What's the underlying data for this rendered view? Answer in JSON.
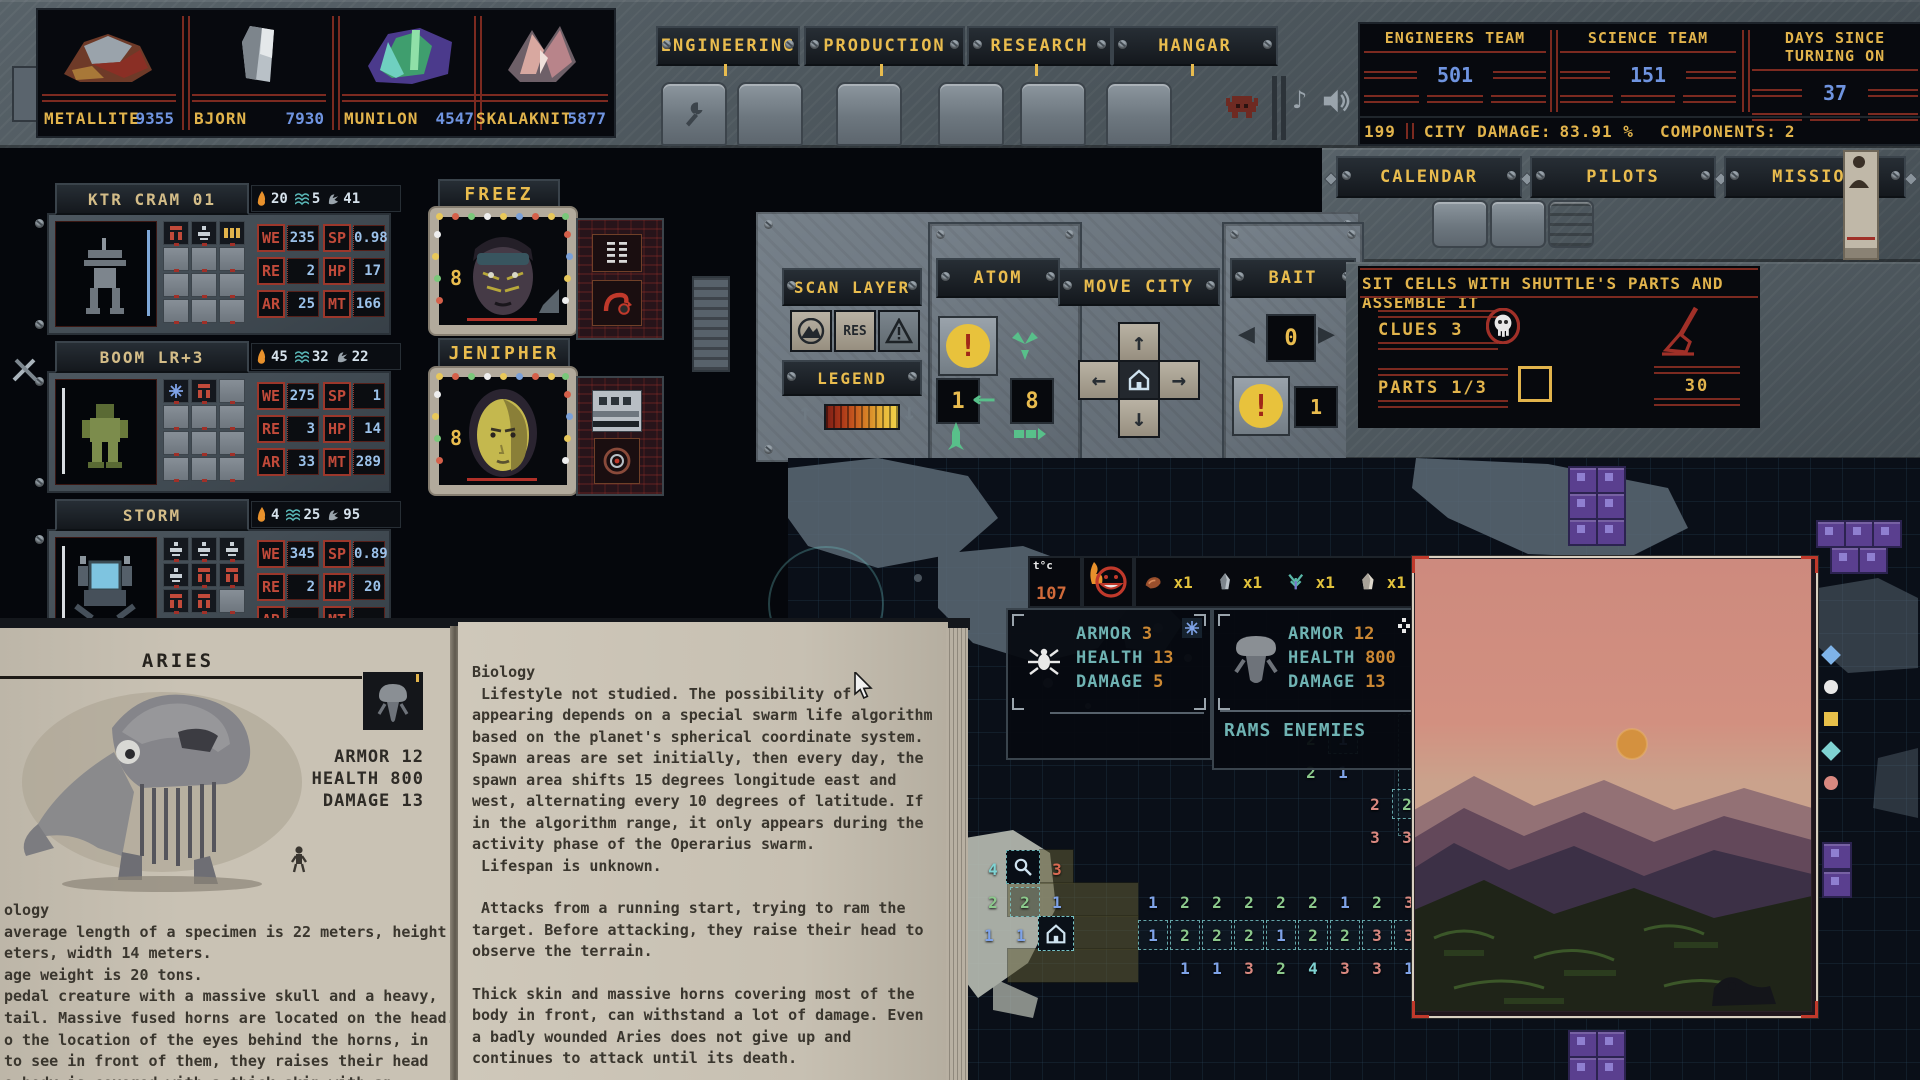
{
  "icons": {
    "music_note": "♪",
    "arrow_up": "↑",
    "arrow_down": "↓",
    "arrow_left": "←",
    "arrow_right": "→",
    "tri_left": "◀",
    "tri_right": "▶",
    "long_arrow_left": "←",
    "warning_mark": "!"
  },
  "resources": [
    {
      "name": "METALLITE",
      "value": "9355"
    },
    {
      "name": "BJORN",
      "value": "7930"
    },
    {
      "name": "MUNILON",
      "value": "4547"
    },
    {
      "name": "SKALAKNIT",
      "value": "5877"
    }
  ],
  "top_tabs": [
    {
      "label": "ENGINEERING"
    },
    {
      "label": "PRODUCTION"
    },
    {
      "label": "RESEARCH"
    },
    {
      "label": "HANGAR"
    }
  ],
  "teams": [
    {
      "label": "ENGINEERS TEAM",
      "value": "501"
    },
    {
      "label": "SCIENCE TEAM",
      "value": "151"
    },
    {
      "label": "DAYS SINCE TURNING ON",
      "value": "37"
    }
  ],
  "status": {
    "left_value": "199",
    "city_damage_label": "CITY DAMAGE:",
    "city_damage_value": "83.91 %",
    "components_label": "COMPONENTS:",
    "components_value": "2"
  },
  "nav_tabs": [
    {
      "label": "CALENDAR"
    },
    {
      "label": "PILOTS"
    },
    {
      "label": "MISSION"
    }
  ],
  "stat_labels": {
    "we": "WE",
    "sp": "SP",
    "re": "RE",
    "hp": "HP",
    "ar": "AR",
    "mt": "MT"
  },
  "mechs": [
    {
      "name": "KTR CRAM 01",
      "heat": "20",
      "web": "5",
      "claw": "41",
      "we": "235",
      "sp": "0.98",
      "re": "2",
      "hp": "17",
      "ar": "25",
      "mt": "166"
    },
    {
      "name": "BOOM LR+3",
      "heat": "45",
      "web": "32",
      "claw": "22",
      "we": "275",
      "sp": "1",
      "re": "3",
      "hp": "14",
      "ar": "33",
      "mt": "289"
    },
    {
      "name": "STORM",
      "heat": "4",
      "web": "25",
      "claw": "95",
      "we": "345",
      "sp": "0.89",
      "re": "2",
      "hp": "20",
      "ar": "",
      "mt": ""
    }
  ],
  "pilots": [
    {
      "name": "FREEZ",
      "badge": "8"
    },
    {
      "name": "JENIPHER",
      "badge": "8"
    }
  ],
  "scan": {
    "title": "SCAN LAYER",
    "res": "RES",
    "legend": "LEGEND"
  },
  "atom": {
    "title": "ATOM",
    "left": "1",
    "right": "8"
  },
  "move_city": {
    "title": "MOVE CITY"
  },
  "bait": {
    "title": "BAIT",
    "value": "0",
    "count": "1"
  },
  "mission": {
    "title": "SIT CELLS WITH SHUTTLE'S PARTS AND ASSEMBLE IT",
    "clues_label": "CLUES",
    "clues_value": "3",
    "parts_label": "PARTS",
    "parts_value": "1/3",
    "timer": "30"
  },
  "tooltip": {
    "temp_label": "t°c",
    "temp_value": "107",
    "drops": [
      {
        "name": "meat",
        "count": "x1"
      },
      {
        "name": "shard",
        "count": "x1"
      },
      {
        "name": "plant",
        "count": "x1"
      },
      {
        "name": "crystal",
        "count": "x1"
      }
    ]
  },
  "enemies": {
    "small": {
      "armor_label": "ARMOR",
      "armor": "3",
      "health_label": "HEALTH",
      "health": "13",
      "damage_label": "DAMAGE",
      "damage": "5"
    },
    "large": {
      "armor_label": "ARMOR",
      "armor": "12",
      "health_label": "HEALTH",
      "health": "800",
      "damage_label": "DAMAGE",
      "damage": "13",
      "trait": "RAMS ENEMIES"
    }
  },
  "map": {
    "cells": [
      {
        "x": 1300,
        "y": 727,
        "v": "2",
        "c": "g"
      },
      {
        "x": 1332,
        "y": 727,
        "v": "1",
        "c": "b",
        "box": true
      },
      {
        "x": 1300,
        "y": 760,
        "v": "2",
        "c": "g"
      },
      {
        "x": 1332,
        "y": 760,
        "v": "1",
        "c": "b"
      },
      {
        "x": 1364,
        "y": 792,
        "v": "2",
        "c": "p"
      },
      {
        "x": 1396,
        "y": 792,
        "v": "2",
        "c": "g",
        "box": true
      },
      {
        "x": 1364,
        "y": 825,
        "v": "3",
        "c": "p"
      },
      {
        "x": 1396,
        "y": 825,
        "v": "3",
        "c": "p"
      },
      {
        "x": 982,
        "y": 857,
        "v": "4",
        "c": "c"
      },
      {
        "x": 1046,
        "y": 857,
        "v": "3",
        "c": "r"
      },
      {
        "x": 982,
        "y": 890,
        "v": "2",
        "c": "g"
      },
      {
        "x": 1014,
        "y": 890,
        "v": "2",
        "c": "g",
        "box": true
      },
      {
        "x": 1046,
        "y": 890,
        "v": "1",
        "c": "b"
      },
      {
        "x": 1142,
        "y": 890,
        "v": "1",
        "c": "b"
      },
      {
        "x": 1174,
        "y": 890,
        "v": "2",
        "c": "g"
      },
      {
        "x": 1206,
        "y": 890,
        "v": "2",
        "c": "g"
      },
      {
        "x": 1238,
        "y": 890,
        "v": "2",
        "c": "g"
      },
      {
        "x": 1270,
        "y": 890,
        "v": "2",
        "c": "g"
      },
      {
        "x": 1302,
        "y": 890,
        "v": "2",
        "c": "g"
      },
      {
        "x": 1334,
        "y": 890,
        "v": "1",
        "c": "b"
      },
      {
        "x": 1366,
        "y": 890,
        "v": "2",
        "c": "g"
      },
      {
        "x": 1398,
        "y": 890,
        "v": "3",
        "c": "p"
      },
      {
        "x": 978,
        "y": 923,
        "v": "1",
        "c": "b"
      },
      {
        "x": 1010,
        "y": 923,
        "v": "1",
        "c": "b"
      },
      {
        "x": 1142,
        "y": 923,
        "v": "1",
        "c": "b",
        "box": true
      },
      {
        "x": 1174,
        "y": 923,
        "v": "2",
        "c": "g",
        "box": true
      },
      {
        "x": 1206,
        "y": 923,
        "v": "2",
        "c": "g",
        "box": true
      },
      {
        "x": 1238,
        "y": 923,
        "v": "2",
        "c": "g",
        "box": true
      },
      {
        "x": 1270,
        "y": 923,
        "v": "1",
        "c": "b",
        "box": true
      },
      {
        "x": 1302,
        "y": 923,
        "v": "2",
        "c": "g",
        "box": true
      },
      {
        "x": 1334,
        "y": 923,
        "v": "2",
        "c": "g",
        "box": true
      },
      {
        "x": 1366,
        "y": 923,
        "v": "3",
        "c": "p",
        "box": true
      },
      {
        "x": 1398,
        "y": 923,
        "v": "3",
        "c": "p",
        "box": true
      },
      {
        "x": 1174,
        "y": 956,
        "v": "1",
        "c": "b"
      },
      {
        "x": 1206,
        "y": 956,
        "v": "1",
        "c": "b"
      },
      {
        "x": 1238,
        "y": 956,
        "v": "3",
        "c": "p"
      },
      {
        "x": 1270,
        "y": 956,
        "v": "2",
        "c": "g"
      },
      {
        "x": 1302,
        "y": 956,
        "v": "4",
        "c": "c"
      },
      {
        "x": 1334,
        "y": 956,
        "v": "3",
        "c": "p"
      },
      {
        "x": 1366,
        "y": 956,
        "v": "3",
        "c": "p"
      },
      {
        "x": 1398,
        "y": 956,
        "v": "1",
        "c": "b"
      }
    ]
  },
  "bestiary": {
    "title": "ARIES",
    "stats": [
      "ARMOR 12",
      "HEALTH 800",
      "DAMAGE 13"
    ],
    "left_lines": [
      "ology",
      "average length of a specimen is 22 meters, height",
      "eters, width 14 meters.",
      "age weight is 20 tons.",
      "pedal creature with a massive skull and a heavy,",
      "tail. Massive fused horns are located on the head.",
      "o the location of the eyes behind the horns, in",
      "to see in front of them, they raises their head",
      "e body is covered with a thick skin with an"
    ],
    "right_paragraphs": [
      "Biology",
      " Lifestyle not studied. The possibility of appearing depends on a special swarm life algorithm based on the planet's spherical coordinate system. Spawn areas are set initially, then every day, the spawn area shifts 15 degrees longitude east and west, alternating every 10 degrees of latitude. If in the algorithm range, it only appears during the activity phase of the Operarius swarm.",
      " Lifespan is unknown.",
      "",
      " Attacks from a running start, trying to ram the target. Before attacking, they raise their head to observe the terrain.",
      "",
      "Thick skin and massive horns covering most of the body in front, can withstand a lot of damage. Even a badly wounded Aries does not give up and continues to attack until its death."
    ]
  }
}
